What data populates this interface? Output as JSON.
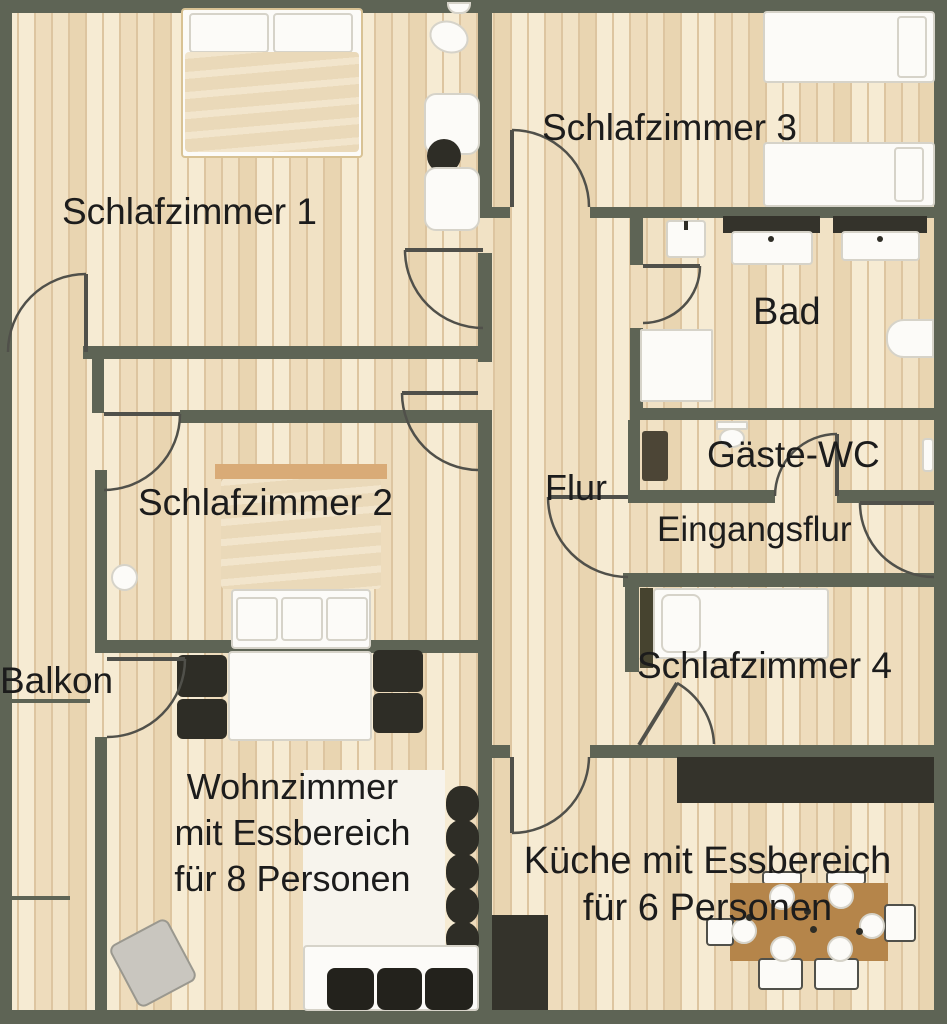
{
  "title": "Apartment floor plan",
  "rooms": {
    "schlafzimmer1": {
      "label": "Schlafzimmer 1"
    },
    "schlafzimmer2": {
      "label": "Schlafzimmer 2"
    },
    "schlafzimmer3": {
      "label": "Schlafzimmer 3"
    },
    "schlafzimmer4": {
      "label": "Schlafzimmer 4"
    },
    "bad": {
      "label": "Bad"
    },
    "gaeste_wc": {
      "label": "Gäste-WC"
    },
    "flur": {
      "label": "Flur"
    },
    "eingangsflur": {
      "label": "Eingangsflur"
    },
    "balkon": {
      "label": "Balkon"
    },
    "wohnzimmer": {
      "line1": "Wohnzimmer",
      "line2": "mit Essbereich",
      "line3": "für 8 Personen"
    },
    "kueche": {
      "line1": "Küche mit Essbereich",
      "line2": "für 6 Personen"
    }
  },
  "furniture_icons": [
    "double-bed",
    "single-bed",
    "pillow",
    "washbasin",
    "vanity-sink",
    "shower",
    "bathtub",
    "toilet",
    "wardrobe-cabinet",
    "dining-table",
    "dining-chair",
    "sofa",
    "armchair",
    "kitchen-counter",
    "kitchen-dining-table",
    "plate",
    "rug",
    "shelf-stack",
    "round-side-table",
    "door-swing",
    "balcony-divider"
  ],
  "colors": {
    "wall": "#5e6455",
    "door": "#50504a",
    "text": "#1c1c1c",
    "floor_base": "#f1e2c5",
    "floor_light": "#f6ebd3",
    "floor_mid": "#eedcbc",
    "floor_dark": "#e9d5b1",
    "plank_line": "#ddc5a0",
    "white": "#fcfbf8",
    "bed_border": "#d6d3c9",
    "bed_frame": "#d8c294",
    "duvet": "#ead9b9",
    "duvet_light": "#f2e5cc",
    "headboard": "#d9ab77",
    "dark": "#2e2d26",
    "counter": "#34332b",
    "wood_table": "#b5854a",
    "armchair": "#c9c6bf",
    "rug": "#f7f4ed",
    "cabinet": "#4c4536",
    "sofa_cushion": "#23221c",
    "headboard_dark": "#46432f"
  }
}
